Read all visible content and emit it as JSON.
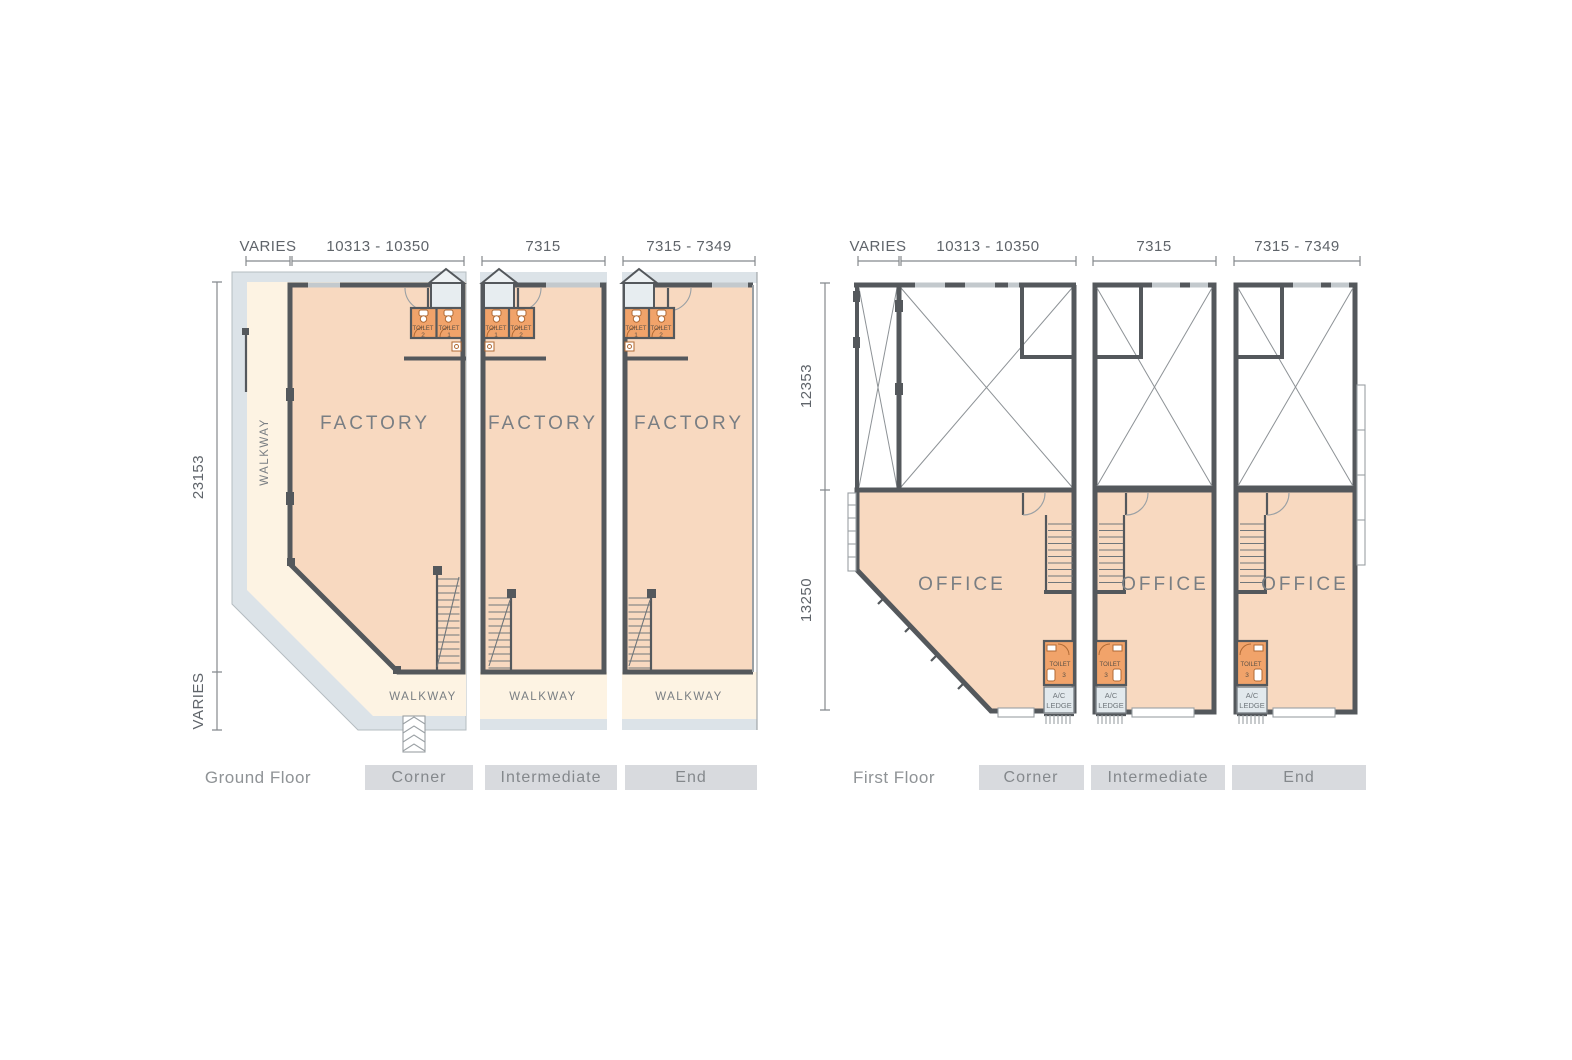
{
  "colors": {
    "site_band": "#dce3e8",
    "walkway": "#fdf3e3",
    "unit_floor": "#f8d9c0",
    "toilet_room": "#f1a36a",
    "ac_ledge": "#e2e9ed",
    "wall": "#54585c",
    "dimension_text": "#5f646a",
    "label_box": "#d8dade"
  },
  "ground": {
    "floor_label": "Ground Floor",
    "top_dims": [
      "VARIES",
      "10313 - 10350",
      "7315",
      "7315 - 7349"
    ],
    "side_dims": [
      "23153",
      "VARIES"
    ],
    "unit_tabs": [
      "Corner",
      "Intermediate",
      "End"
    ],
    "units": [
      {
        "room": "FACTORY",
        "walkway_side": "WALKWAY",
        "walkway_front": "WALKWAY",
        "toilets": [
          {
            "label": "TOILET",
            "num": "2"
          },
          {
            "label": "TOILET",
            "num": "1"
          }
        ]
      },
      {
        "room": "FACTORY",
        "walkway_front": "WALKWAY",
        "toilets": [
          {
            "label": "TOILET",
            "num": "1"
          },
          {
            "label": "TOILET",
            "num": "2"
          }
        ]
      },
      {
        "room": "FACTORY",
        "walkway_front": "WALKWAY",
        "toilets": [
          {
            "label": "TOILET",
            "num": "1"
          },
          {
            "label": "TOILET",
            "num": "2"
          }
        ]
      }
    ]
  },
  "first": {
    "floor_label": "First Floor",
    "top_dims": [
      "VARIES",
      "10313 - 10350",
      "7315",
      "7315 - 7349"
    ],
    "side_dims": [
      "12353",
      "13250"
    ],
    "unit_tabs": [
      "Corner",
      "Intermediate",
      "End"
    ],
    "units": [
      {
        "room": "OFFICE",
        "toilet": {
          "label": "TOILET",
          "num": "3"
        },
        "ac_ledge": [
          "A/C",
          "LEDGE"
        ]
      },
      {
        "room": "OFFICE",
        "toilet": {
          "label": "TOILET",
          "num": "3"
        },
        "ac_ledge": [
          "A/C",
          "LEDGE"
        ]
      },
      {
        "room": "OFFICE",
        "toilet": {
          "label": "TOILET",
          "num": "3"
        },
        "ac_ledge": [
          "A/C",
          "LEDGE"
        ]
      }
    ]
  }
}
